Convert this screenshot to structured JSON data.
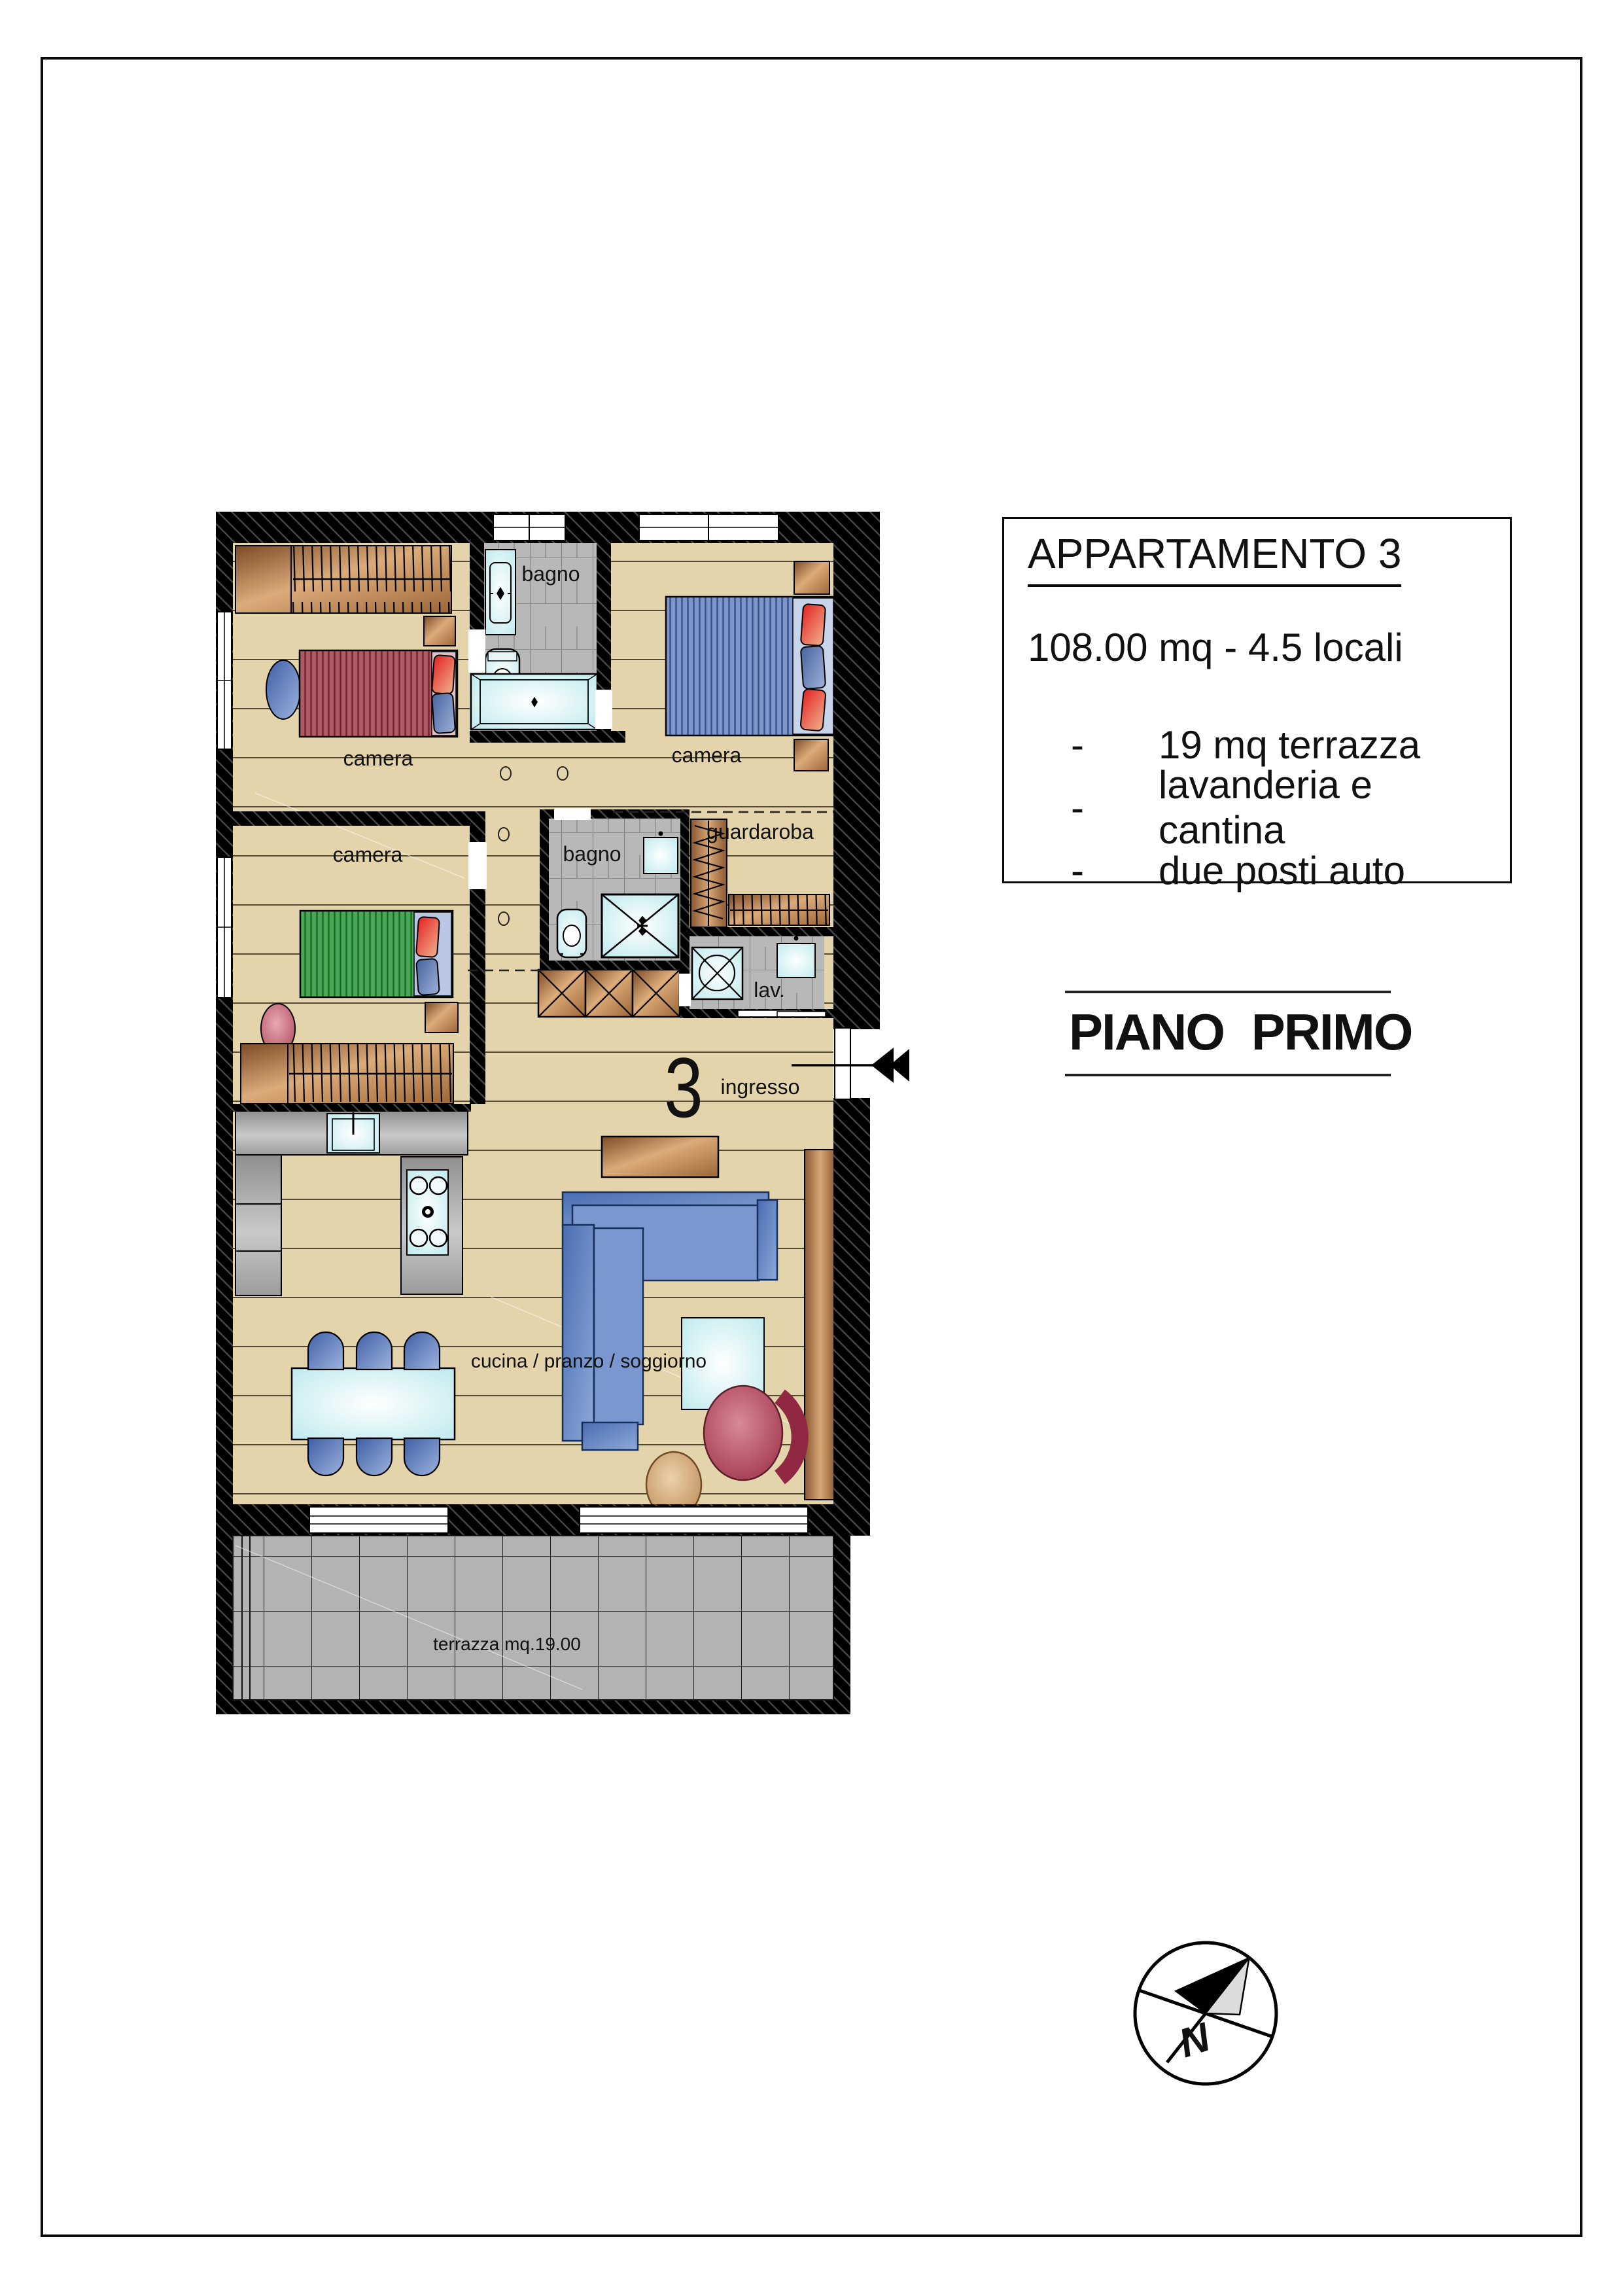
{
  "info_box": {
    "title": "APPARTAMENTO 3",
    "area_line": "108.00 mq - 4.5 locali",
    "bullet_marker": "-",
    "bullets": [
      "19 mq terrazza",
      "lavanderia e cantina",
      "due posti auto"
    ]
  },
  "floor_title": "PIANO PRIMO",
  "compass": {
    "north_label": "N"
  },
  "plan": {
    "unit_number": "3",
    "labels": {
      "camera_top_left": "camera",
      "camera_top_right": "camera",
      "camera_mid_left": "camera",
      "bagno_top": "bagno",
      "bagno_mid": "bagno",
      "guardaroba": "guardaroba",
      "laundry": "lav.",
      "entrance": "ingresso",
      "living": "cucina / pranzo / soggiorno",
      "terrace": "terrazza mq.19.00"
    },
    "colors": {
      "wall": "#000000",
      "wood_floor": "#e4d4ab",
      "tile_floor": "#b9b9b9",
      "terrace_tile": "#b3b3b3",
      "fixture_cyan": "#d8f2f3",
      "counter_gray": "#9a9a9a",
      "bed_red": "#a03848",
      "bed_blue": "#5b79b8",
      "bed_green": "#2f9e42",
      "sofa_blue": "#5b7fc0",
      "furniture_brown": "#b97f4e"
    }
  }
}
